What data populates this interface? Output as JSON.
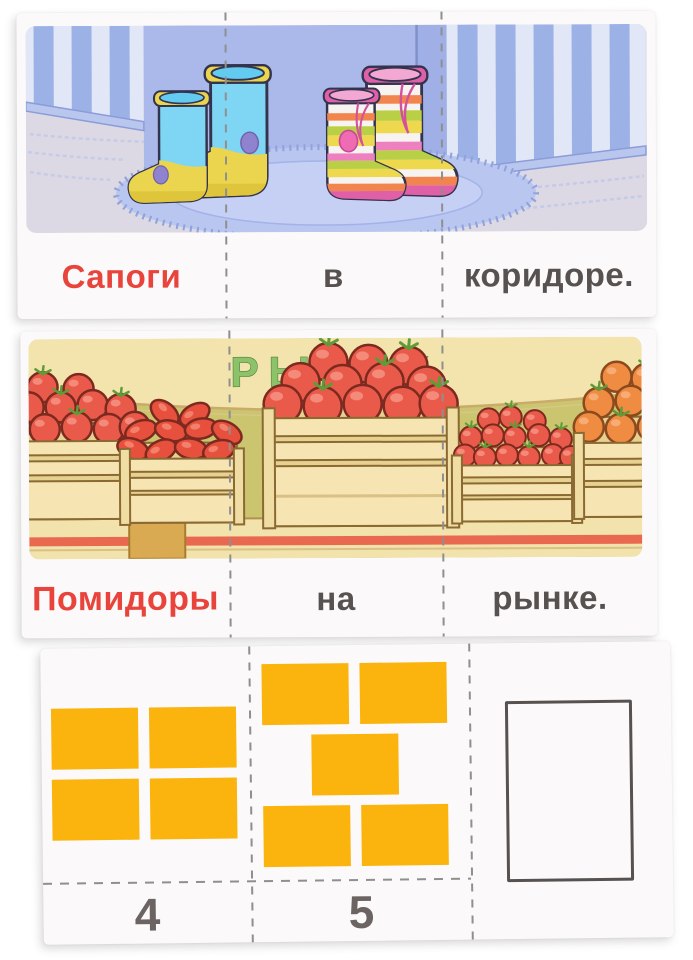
{
  "cards": {
    "boots": {
      "subject": "Сапоги",
      "preposition": "в",
      "object": "коридоре.",
      "scene": "rubber-boots-on-rug-in-hallway"
    },
    "market": {
      "sign": "РЫНОК",
      "subject": "Помидоры",
      "preposition": "на",
      "object": "рынке.",
      "scene": "tomato-crates-at-market-stall"
    },
    "counting": {
      "sections": [
        {
          "number": "4",
          "rows": [
            2,
            2
          ]
        },
        {
          "number": "5",
          "rows": [
            2,
            1,
            2
          ]
        },
        {
          "number": "",
          "rows": []
        }
      ]
    }
  },
  "colors": {
    "accent_red": "#e8443c",
    "text_gray": "#575250",
    "number_gray": "#6b6462",
    "tile_orange": "#fbb40e",
    "sign_green": "#8cc26a",
    "card_background": "#fbf9f9"
  }
}
